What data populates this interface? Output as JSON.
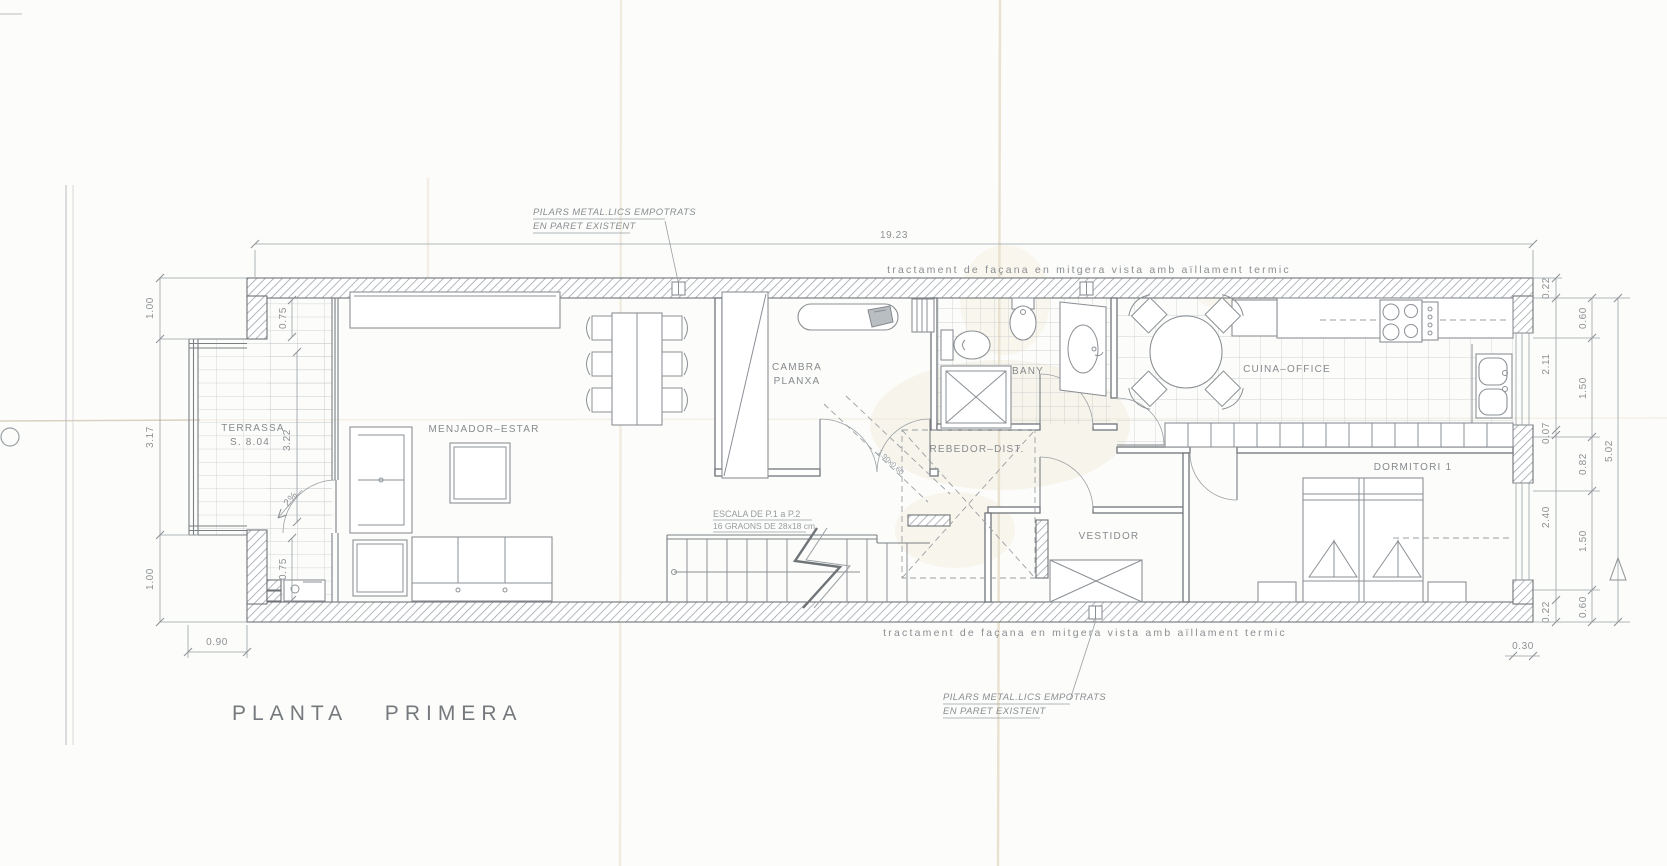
{
  "sheet": {
    "title": "PLANTA PRIMERA"
  },
  "notes": {
    "pilars_line1": "PILARS METAL.LICS EMPOTRATS",
    "pilars_line2": "EN PARET EXISTENT",
    "facade": "tractament de façana en mitgera vista amb aïllament termic"
  },
  "rooms": {
    "terrassa_name": "TERRASSA",
    "terrassa_area": "S. 8.04",
    "menjador": "MENJADOR–ESTAR",
    "cambra_line1": "CAMBRA",
    "cambra_line2": "PLANXA",
    "bany": "BANY",
    "cuina": "CUINA–OFFICE",
    "rebedor": "REBEDOR–DIST.",
    "vestidor": "VESTIDOR",
    "dormitori": "DORMITORI 1"
  },
  "stairs": {
    "line1": "ESCALA DE P.1 a P.2",
    "line2": "16 GRAONS DE 28x18 cm"
  },
  "dims": {
    "total_width": "19.23",
    "left_outer": [
      "1.00",
      "3.17",
      "1.00"
    ],
    "left_inner": [
      "0.75",
      "3.22",
      "0.75"
    ],
    "bottom_left": "0.90",
    "right_col1": [
      "0.22",
      "2.11",
      "0.07",
      "2.40",
      "0.22"
    ],
    "right_col2": [
      "0.60",
      "1.50",
      "0.82",
      "1.50",
      "0.60"
    ],
    "right_total": "5.02",
    "bottom_right": "0.30",
    "slope": "2%",
    "stair_opening": "1.90x0.60"
  }
}
